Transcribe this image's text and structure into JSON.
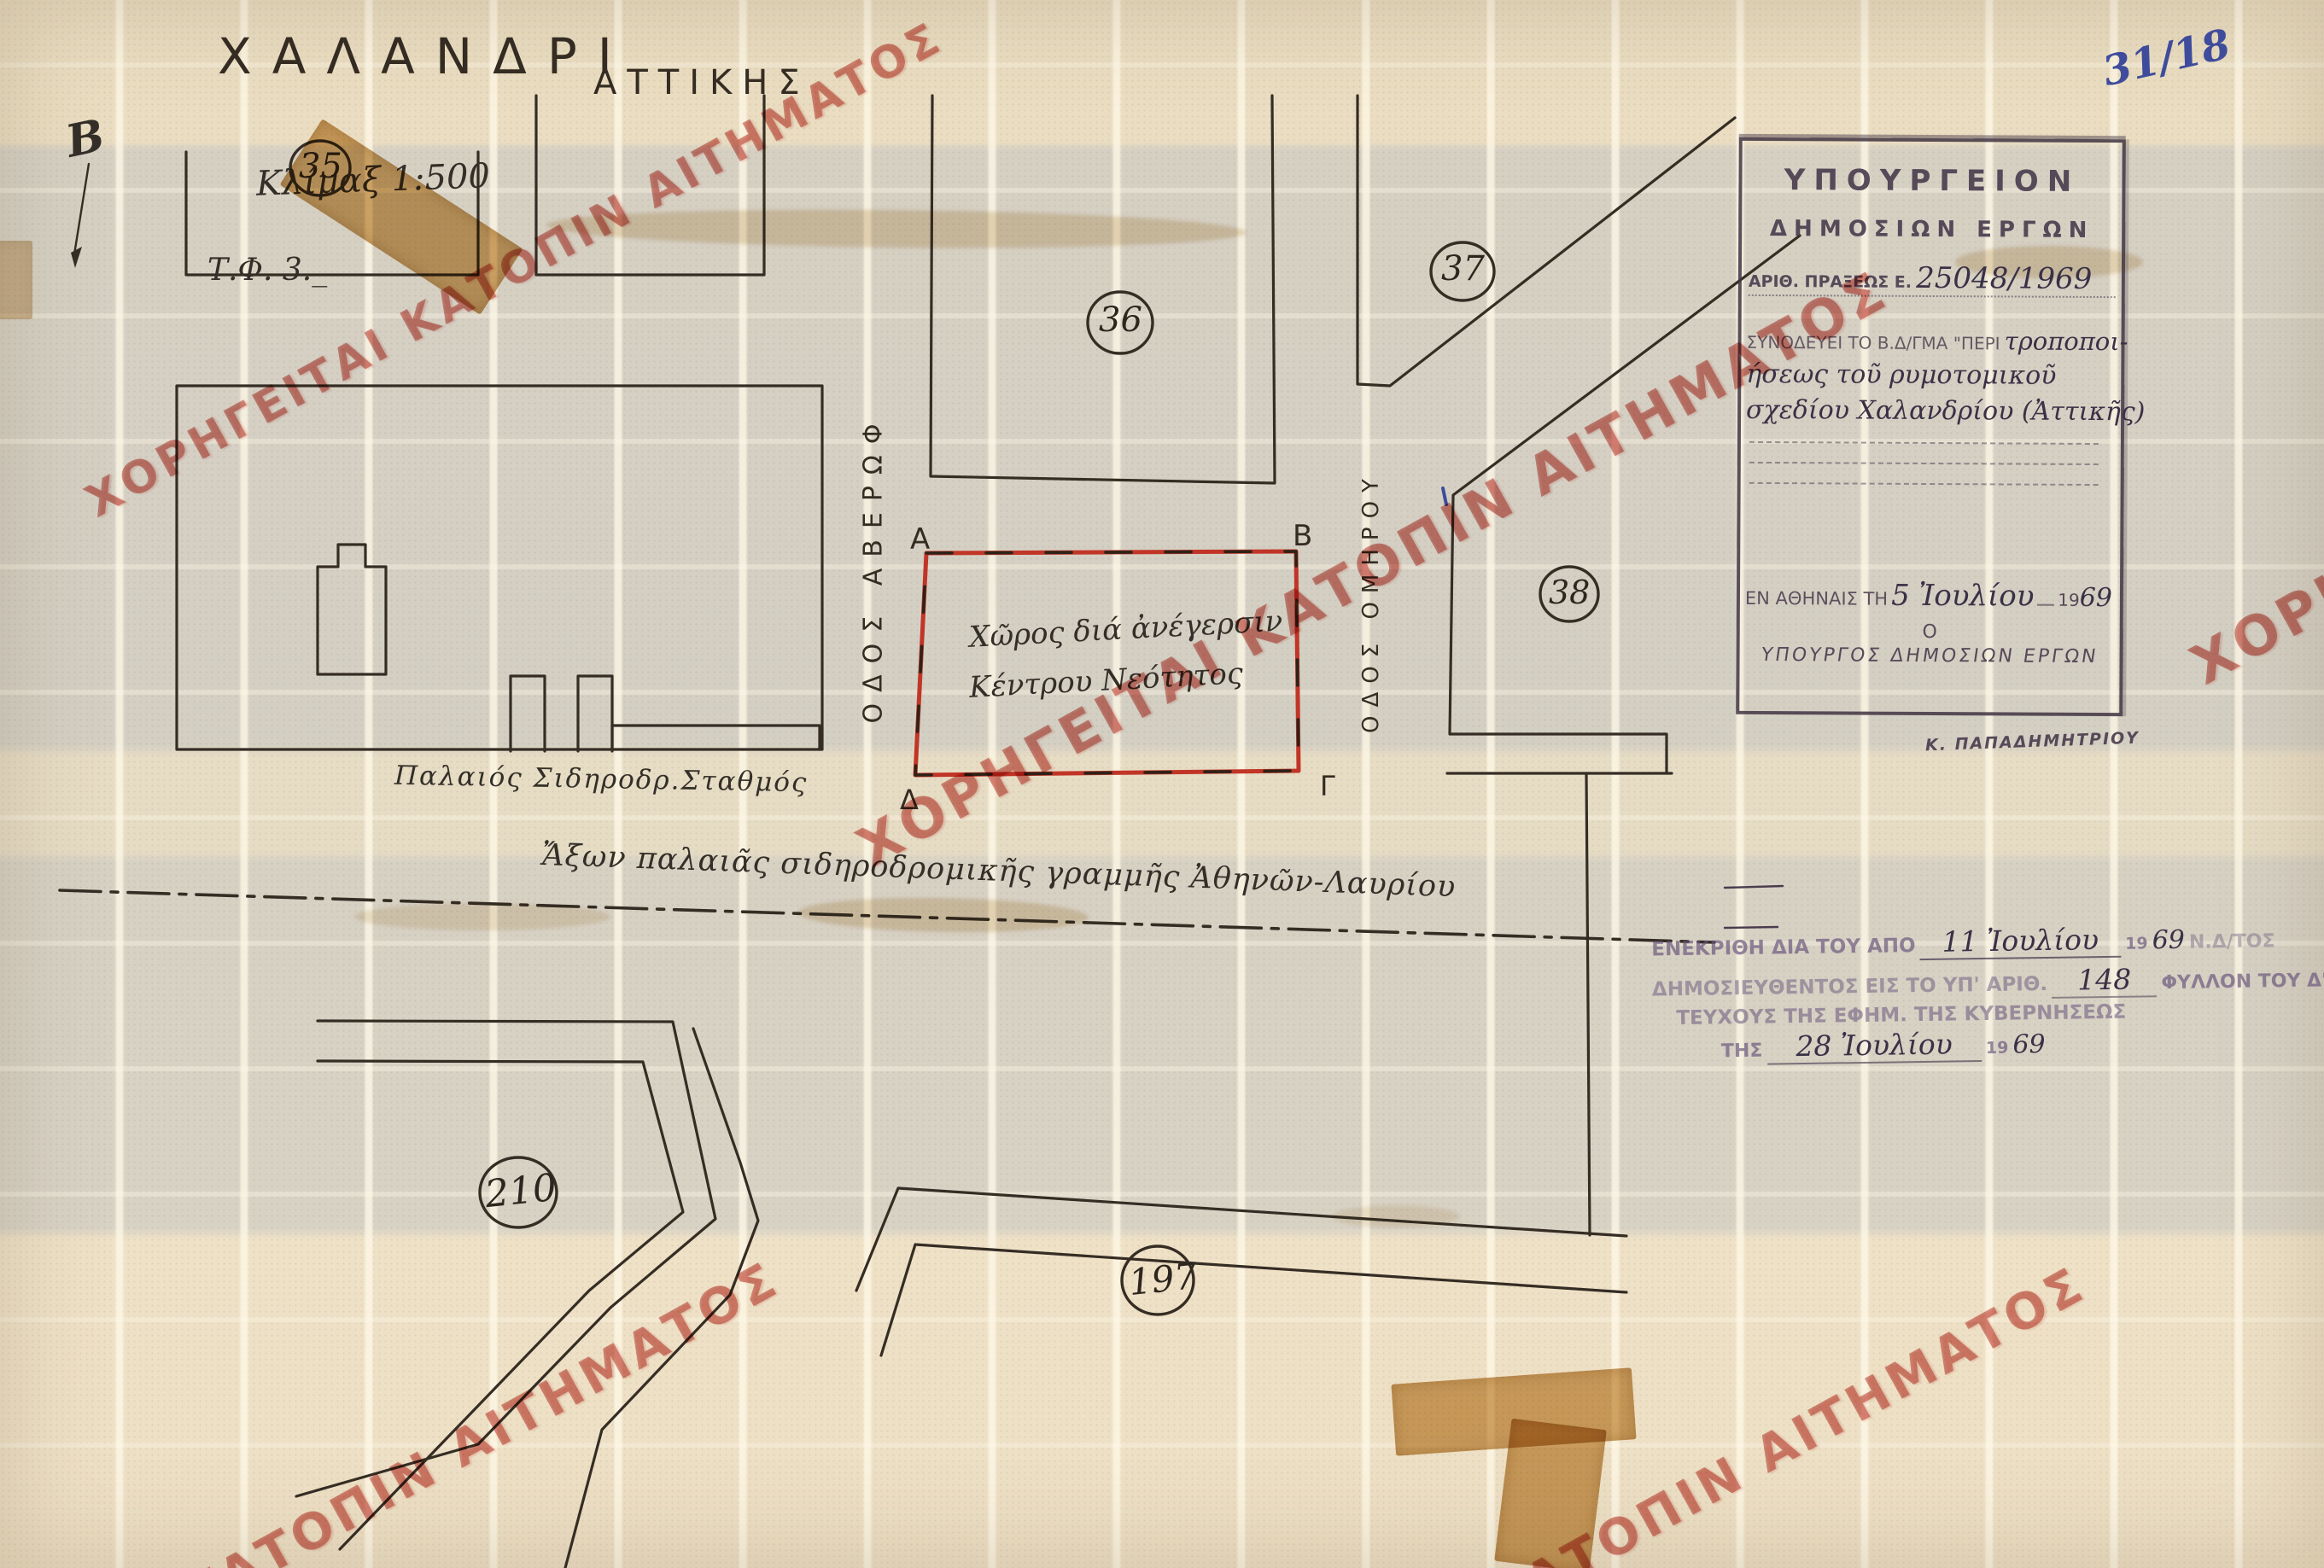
{
  "document": {
    "annotation_ref": "31/18",
    "title": "ΧΑΛΑΝΔΡΙ",
    "region": "ΑΤΤΙΚΗΣ",
    "scale": "Κλίμαξ 1:500",
    "sheet": "Τ.Φ. 3._"
  },
  "map": {
    "blocks": {
      "b35": "35",
      "b36": "36",
      "b37": "37",
      "b38": "38",
      "b210": "210",
      "b197": "197"
    },
    "corners": {
      "a": "Α",
      "b": "Β",
      "g": "Γ",
      "d": "Δ"
    },
    "streets": {
      "averof": "ΟΔΟΣ ΑΒΕΡΩΦ",
      "omirou": "ΟΔΟΣ ΟΜΗΡΟΥ"
    },
    "site": {
      "line1": "Χῶρος διά ἀνέγερσιν",
      "line2": "Κέντρου Νεότητος"
    },
    "station_label": "Παλαιός Σιδηροδρ.Σταθμός",
    "railway_axis_label": "Ἄξων παλαιᾶς σιδηροδρομικῆς γραμμῆς Ἀθηνῶν-Λαυρίου",
    "north_mark": "B"
  },
  "ministry_stamp": {
    "line1": "ΥΠΟΥΡΓΕΙΟΝ",
    "line2": "ΔΗΜΟΣΙΩΝ ΕΡΓΩΝ",
    "act_label": "ΑΡΙΘ. ΠΡΑΞΕΩΣ Ε.",
    "act_number": "25048/1969",
    "decree_intro": "ΣΥΝΟΔΕΥΕΙ ΤΟ Β.Δ/ΓΜΑ \"ΠΕΡΙ",
    "decree_hw1": "τροποποι-",
    "decree_hw2": "ήσεως τοῦ ρυμοτομικοῦ",
    "decree_hw3": "σχεδίου Χαλανδρίου (Ἀττικῆς)",
    "place_label": "ΕΝ ΑΘΗΝΑΙΣ ΤΗ",
    "date_hw": "5 Ἰουλίου",
    "year_printed": "19",
    "year_hw": "69",
    "signatory_article": "Ο",
    "signatory_title": "ΥΠΟΥΡΓΟΣ ΔΗΜΟΣΙΩΝ ΕΡΓΩΝ",
    "signatory_name": "Κ. ΠΑΠΑΔΗΜΗΤΡΙΟΥ"
  },
  "approval_stamp": {
    "line1_printed": "ΕΝΕΚΡΙΘΗ ΔΙΑ ΤΟΥ ΑΠΟ",
    "line1_hw": "11 Ἰουλίου",
    "line1_year_printed": "19",
    "line1_year_hw": "69",
    "line1_tail": "Ν.Δ/ΤΟΣ",
    "line2_printed": "ΔΗΜΟΣΙΕΥΘΕΝΤΟΣ ΕΙΣ ΤΟ ΥΠ' ΑΡΙΘ.",
    "line2_hw": "148",
    "line2_tail": "ΦΥΛΛΟΝ ΤΟΥ Δ'",
    "line3_printed": "ΤΕΥΧΟΥΣ ΤΗΣ ΕΦΗΜ. ΤΗΣ ΚΥΒΕΡΝΗΣΕΩΣ",
    "line4_printed": "ΤΗΣ",
    "line4_hw": "28 Ἰουλίου",
    "line4_year_printed": "19",
    "line4_year_hw": "69"
  },
  "watermark": {
    "full": "ΧΟΡΗΓΕΙΤΑΙ ΚΑΤΟΠΙΝ ΑΙΤΗΜΑΤΟΣ",
    "partial": "ΚΑΤΟΠΙΝ ΑΙΤΗΜΑΤΟΣ",
    "color": "#bf3a2f"
  },
  "colors": {
    "site_outline_red": "#c13527",
    "ink_blue": "#3f4c9c",
    "stamp_purple": "#483a4c",
    "drawing_ink": "#352d24"
  }
}
